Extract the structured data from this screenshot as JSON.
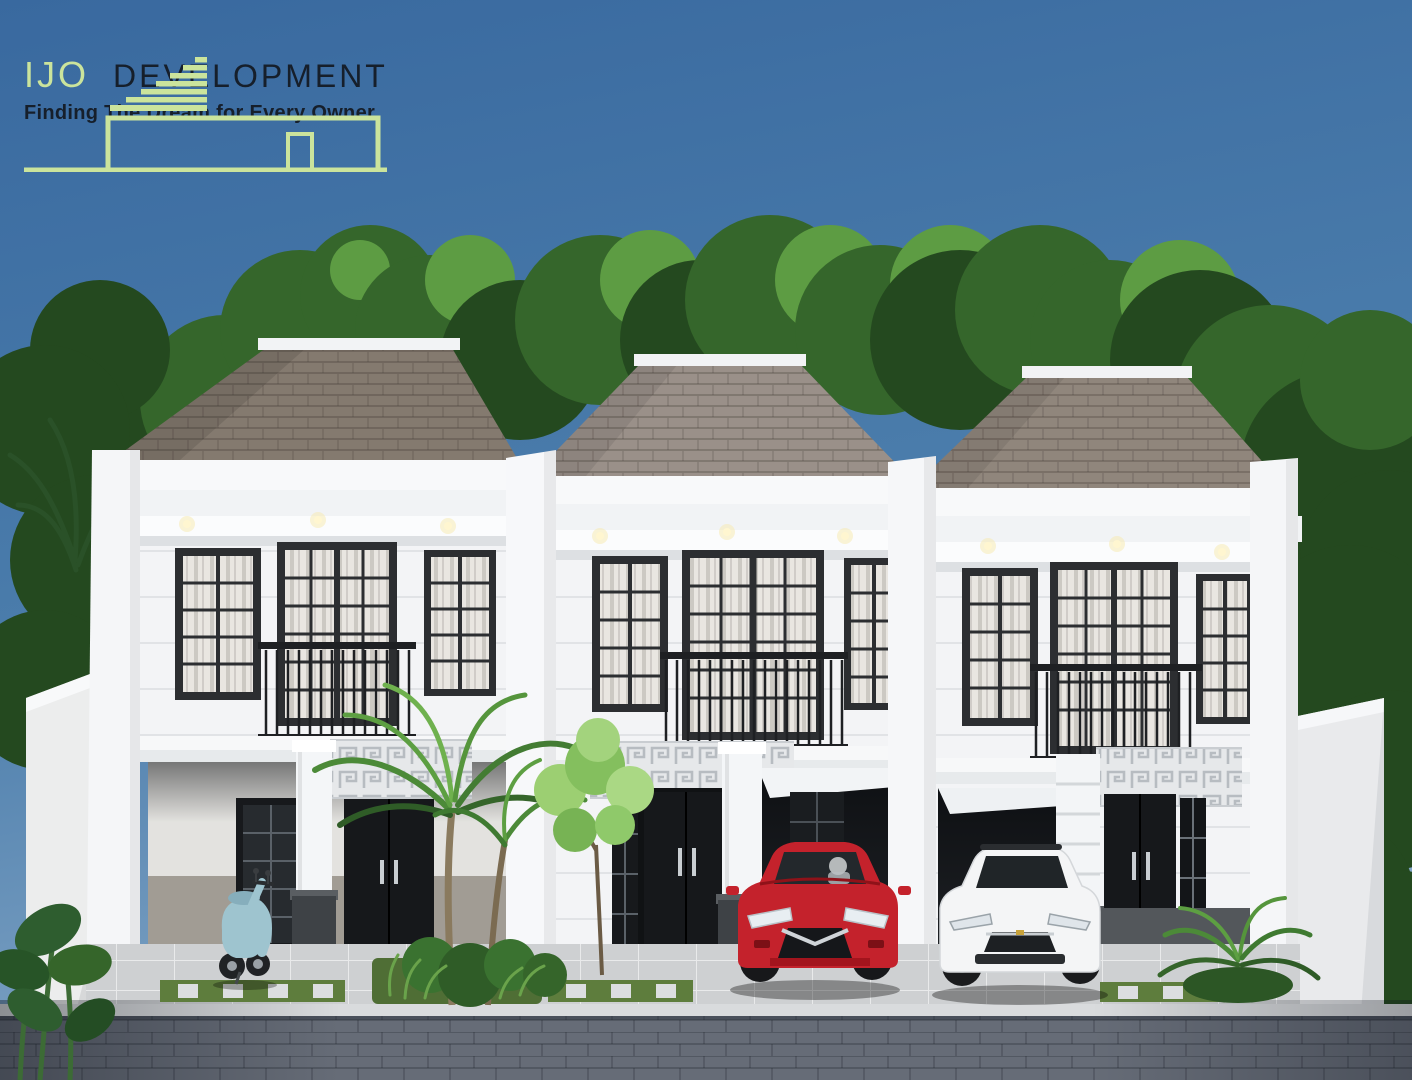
{
  "logo": {
    "brand_primary": "IJO",
    "brand_secondary": "DEVELOPMENT",
    "tagline": "Finding The Dream for Every Owner"
  },
  "colors": {
    "sky_top": "#3a6ca4",
    "sky_bottom": "#7ba0c4",
    "logo_green": "#cbe49c",
    "logo_text": "#161f2b",
    "tree_dark": "#24491f",
    "tree_mid": "#35662b",
    "tree_light": "#5d9c43",
    "roof_left": "#847a6f",
    "roof_mid": "#9a9089",
    "roof_right": "#90867c",
    "roof_cap": "#f2f3f5",
    "facade": "#f3f4f6",
    "frame_dark": "#2c2e31",
    "curtain": "#e9e6e1",
    "railing": "#1e2023",
    "door_black": "#16181b",
    "column_base": "#3e4246",
    "wainscot": "#a19c94",
    "wainscot_dark": "#53575b",
    "greek_band": "#e6e8ea",
    "carport_shadow": "#141619",
    "floor_tile": "#ced0d2",
    "curb": "#d9dbdd",
    "grass": "#5e7d3d",
    "street": "#666c77",
    "car_red": "#c4222c",
    "car_white": "#f4f5f6",
    "scooter_teal": "#9ec4cf"
  }
}
